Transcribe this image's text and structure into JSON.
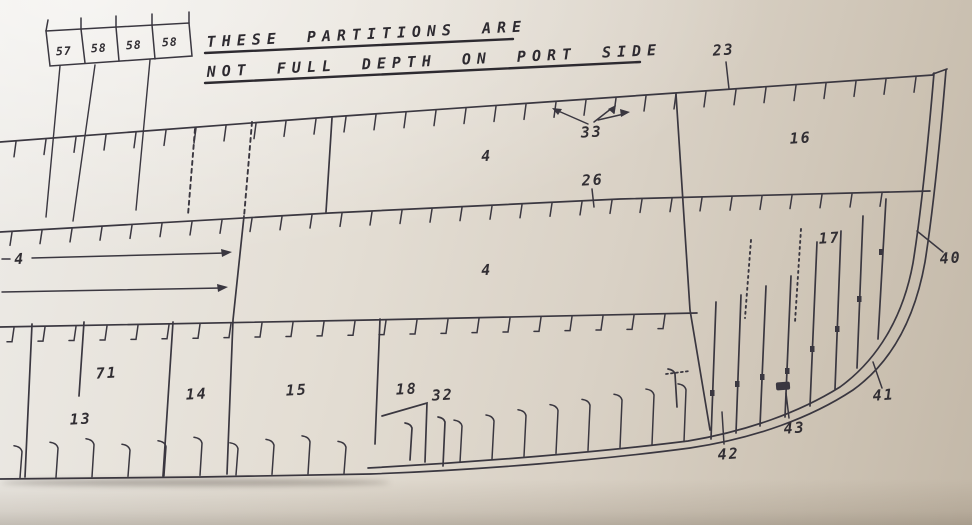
{
  "drawing": {
    "type": "ship bow profile plan (photographed technical drawing)",
    "note": {
      "line1": "THESE PARTITIONS ARE",
      "line2": "NOT FULL DEPTH ON PORT SIDE"
    },
    "partition_boxes": {
      "cells": [
        {
          "label": "57"
        },
        {
          "label": "58"
        },
        {
          "label": "58"
        },
        {
          "label": "58"
        }
      ]
    },
    "hold_labels": {
      "upper": "4",
      "mid": "4",
      "fore": "4"
    },
    "frame_labels": {
      "f23": "23",
      "f26": "26",
      "f33": "33",
      "f40": "40",
      "f41": "41",
      "f42": "42",
      "f43": "43"
    },
    "compartments": {
      "c71": "71",
      "c13": "13",
      "c14": "14",
      "c15": "15",
      "c16": "16",
      "c17": "17",
      "c18": "18",
      "c32": "32"
    },
    "colors": {
      "ink": "#3a3740",
      "paper_light": "#edebe7",
      "paper_dark": "#c3b8a8"
    }
  }
}
